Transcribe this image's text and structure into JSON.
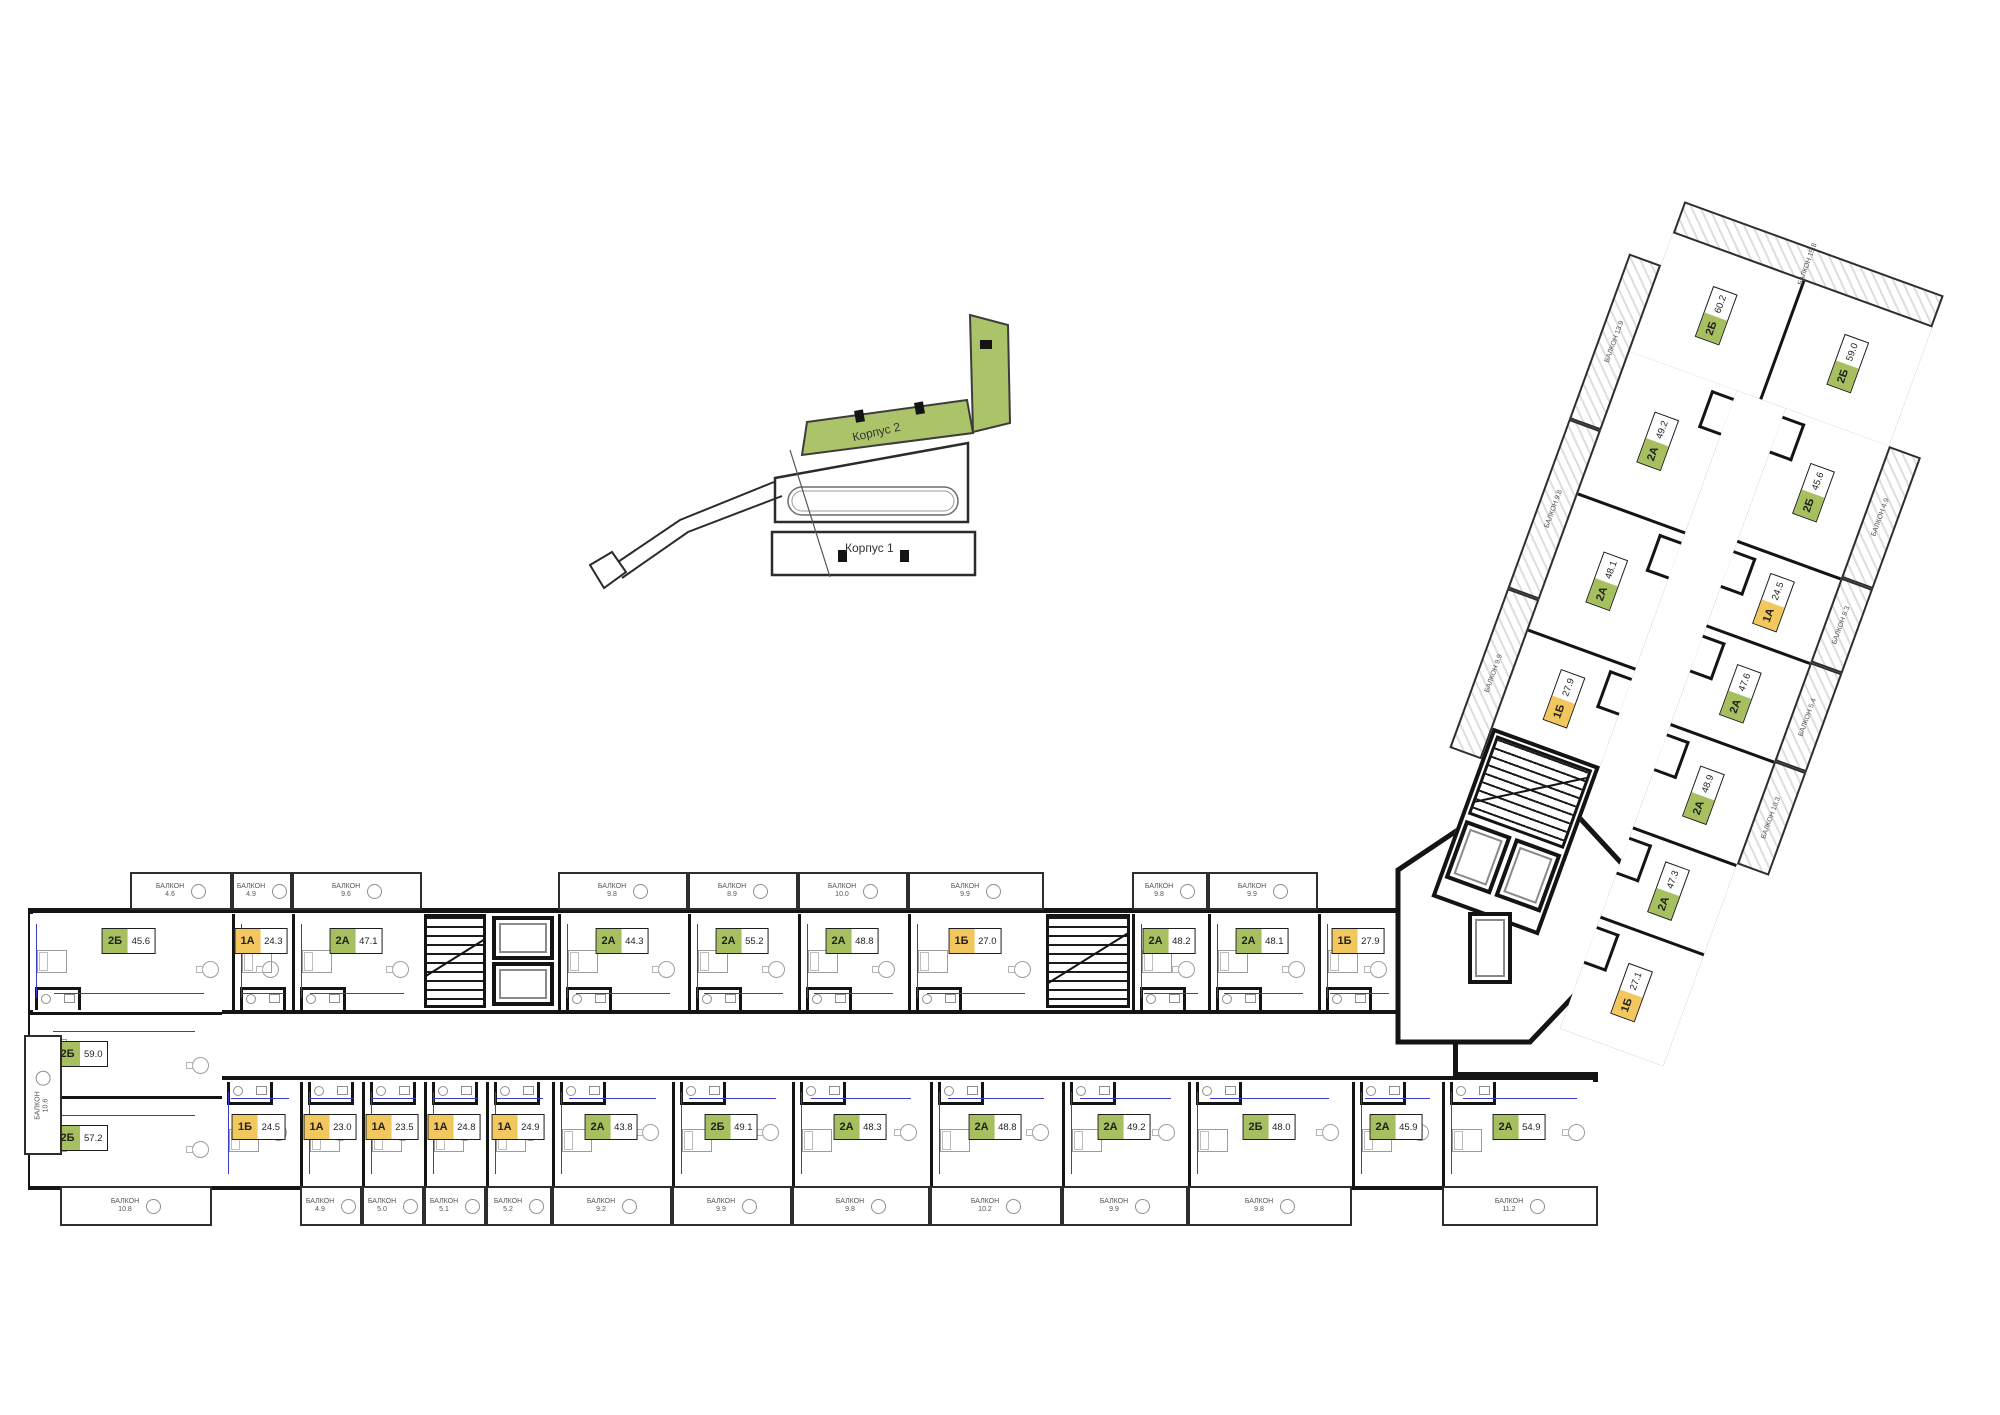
{
  "page": {
    "bg": "#ffffff"
  },
  "colors": {
    "wall": "#141414",
    "green": "#a6bf5f",
    "yellow": "#f2c75e",
    "dim_blue": "#3a3ccb",
    "locator_green": "#abc46a"
  },
  "labels": {
    "balcony_word": "БАЛКОН",
    "korpus1": "Корпус 1",
    "korpus2": "Корпус 2"
  },
  "main_building": {
    "top_row": [
      {
        "type": "2Б",
        "area": "45.6",
        "balcony": "4.6"
      },
      {
        "type": "1А",
        "area": "24.3",
        "balcony": "4.9"
      },
      {
        "type": "2А",
        "area": "47.1",
        "balcony": "9.6"
      },
      {
        "type": "2А",
        "area": "44.3",
        "balcony": "9.8"
      },
      {
        "type": "2А",
        "area": "55.2",
        "balcony": "8.9"
      },
      {
        "type": "2А",
        "area": "48.8",
        "balcony": "10.0"
      },
      {
        "type": "1Б",
        "area": "27.0",
        "balcony": "9.9"
      },
      {
        "type": "2А",
        "area": "48.2",
        "balcony": "9.8"
      },
      {
        "type": "2А",
        "area": "48.1",
        "balcony": "9.9"
      },
      {
        "type": "1Б",
        "area": "27.9",
        "balcony": ""
      }
    ],
    "bottom_row": [
      {
        "type": "1Б",
        "area": "24.5",
        "balcony": ""
      },
      {
        "type": "1А",
        "area": "23.0",
        "balcony": "4.9"
      },
      {
        "type": "1А",
        "area": "23.5",
        "balcony": "5.0"
      },
      {
        "type": "1А",
        "area": "24.8",
        "balcony": "5.1"
      },
      {
        "type": "1А",
        "area": "24.9",
        "balcony": "5.2"
      },
      {
        "type": "2А",
        "area": "43.8",
        "balcony": "9.2"
      },
      {
        "type": "2Б",
        "area": "49.1",
        "balcony": "9.9"
      },
      {
        "type": "2А",
        "area": "48.3",
        "balcony": "9.8"
      },
      {
        "type": "2А",
        "area": "48.8",
        "balcony": "10.2"
      },
      {
        "type": "2А",
        "area": "49.2",
        "balcony": "9.9"
      },
      {
        "type": "2Б",
        "area": "48.0",
        "balcony": "9.8"
      },
      {
        "type": "2А",
        "area": "45.9",
        "balcony": ""
      },
      {
        "type": "2А",
        "area": "54.9",
        "balcony": "11.2"
      }
    ],
    "left_cap": [
      {
        "type": "2Б",
        "area": "59.0",
        "balcony": "10.6"
      },
      {
        "type": "2Б",
        "area": "57.2",
        "balcony": "10.8"
      }
    ]
  },
  "wing": {
    "cap_row": [
      {
        "type": "2Б",
        "area": "60.2"
      },
      {
        "type": "2Б",
        "area": "59.0"
      }
    ],
    "left_column": [
      {
        "type": "2А",
        "area": "49.2"
      },
      {
        "type": "2А",
        "area": "48.1"
      },
      {
        "type": "1Б",
        "area": "27.9"
      }
    ],
    "right_column": [
      {
        "type": "2Б",
        "area": "45.6",
        "balcony": "4.9"
      },
      {
        "type": "1А",
        "area": "24.5",
        "balcony": "5.3"
      },
      {
        "type": "2А",
        "area": "47.6",
        "balcony": "5.4"
      },
      {
        "type": "2А",
        "area": "48.9",
        "balcony": "10.3"
      },
      {
        "type": "2А",
        "area": "47.3",
        "balcony": ""
      },
      {
        "type": "1Б",
        "area": "27.1",
        "balcony": ""
      }
    ],
    "top_balcony": "15.8",
    "left_balconies": [
      "13.9",
      "9.8",
      "9.9"
    ]
  }
}
